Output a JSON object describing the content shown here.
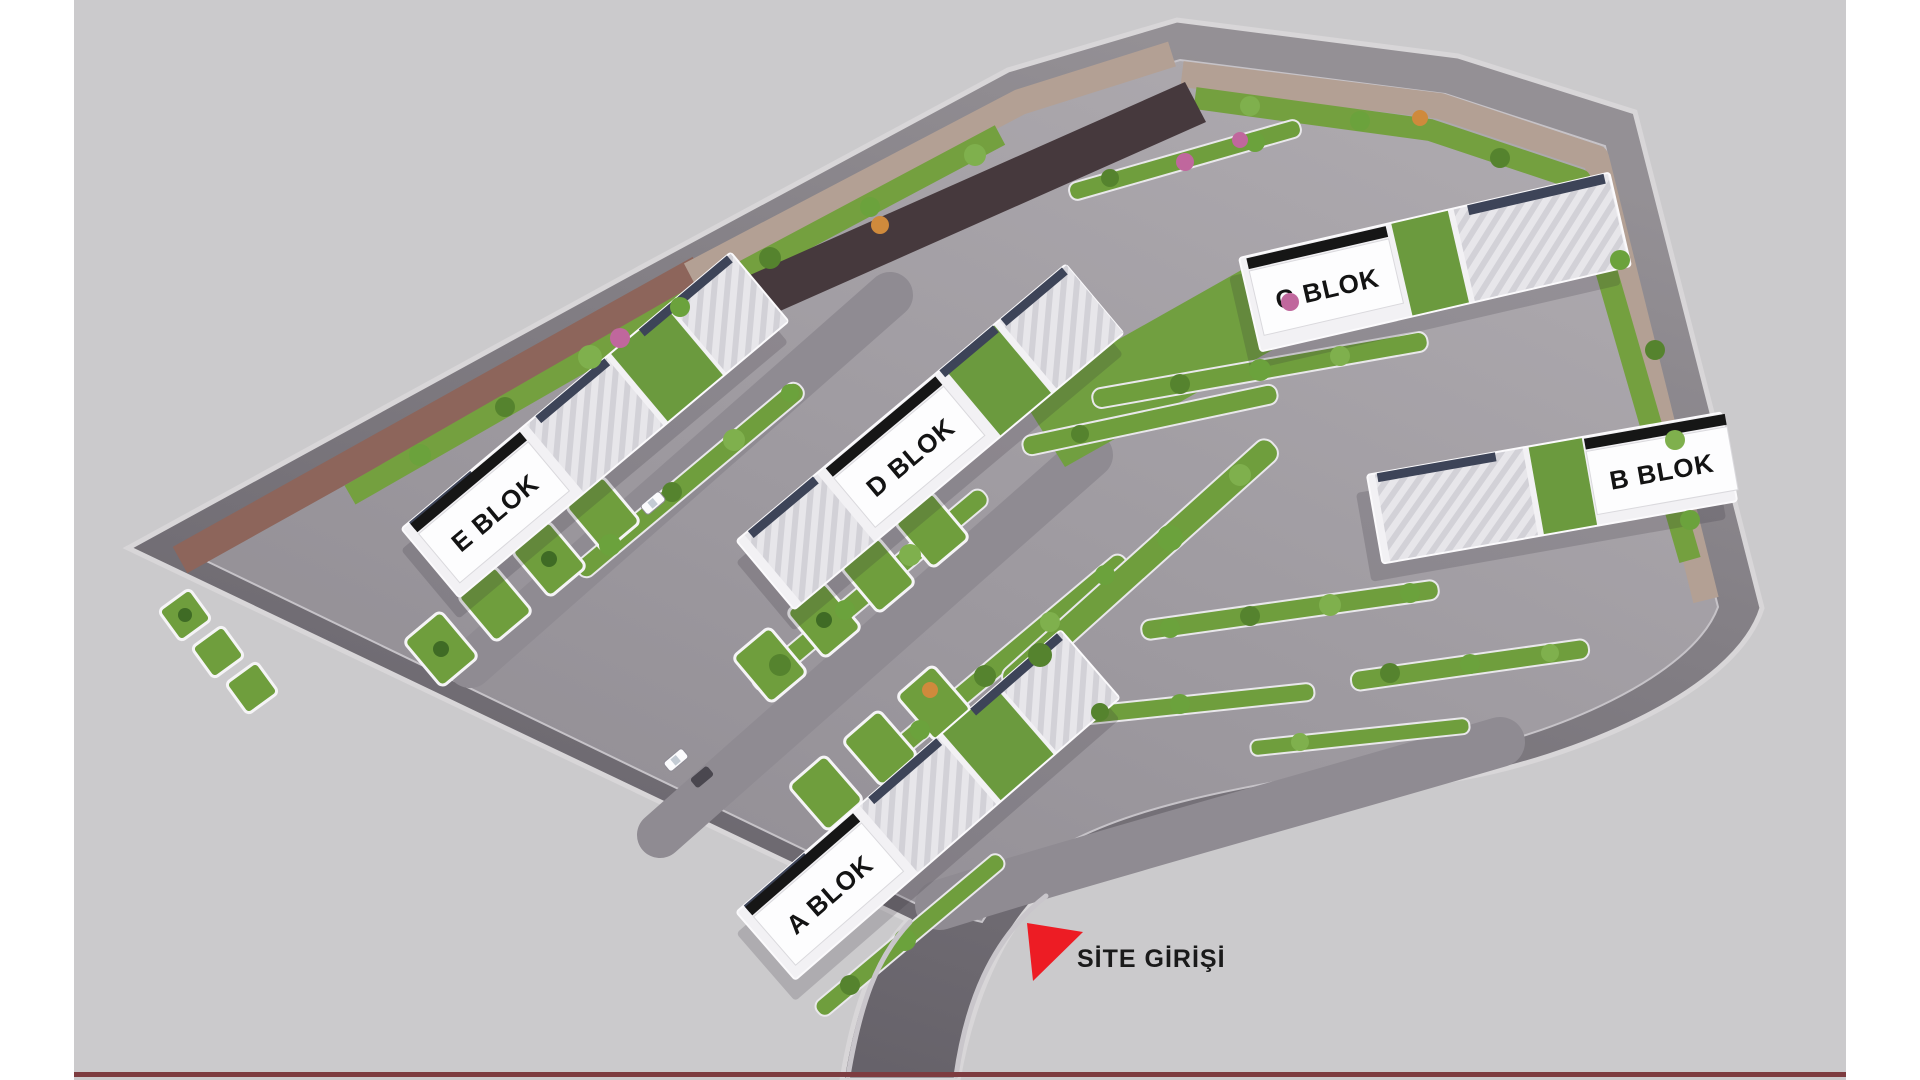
{
  "site_plan": {
    "title_hint": "residential site plan render",
    "blocks": [
      {
        "id": "a",
        "label": "A BLOK"
      },
      {
        "id": "b",
        "label": "B BLOK"
      },
      {
        "id": "c",
        "label": "C BLOK"
      },
      {
        "id": "d",
        "label": "D BLOK"
      },
      {
        "id": "e",
        "label": "E BLOK"
      }
    ],
    "entrance": {
      "label": "SİTE GİRİŞİ",
      "icon": "red-triangle-entrance-arrow",
      "color": "#ed1c24"
    },
    "colors": {
      "background": "#cbcacc",
      "page_margin": "#ffffff",
      "perimeter_road": "#5e5a62",
      "platform": "#9b979d",
      "grass": "#6f9e3d",
      "roof_white": "#f2f1f4",
      "brick_path": "#8d655b",
      "label_text": "#131313",
      "bottom_rule": "#7d3c40"
    }
  }
}
